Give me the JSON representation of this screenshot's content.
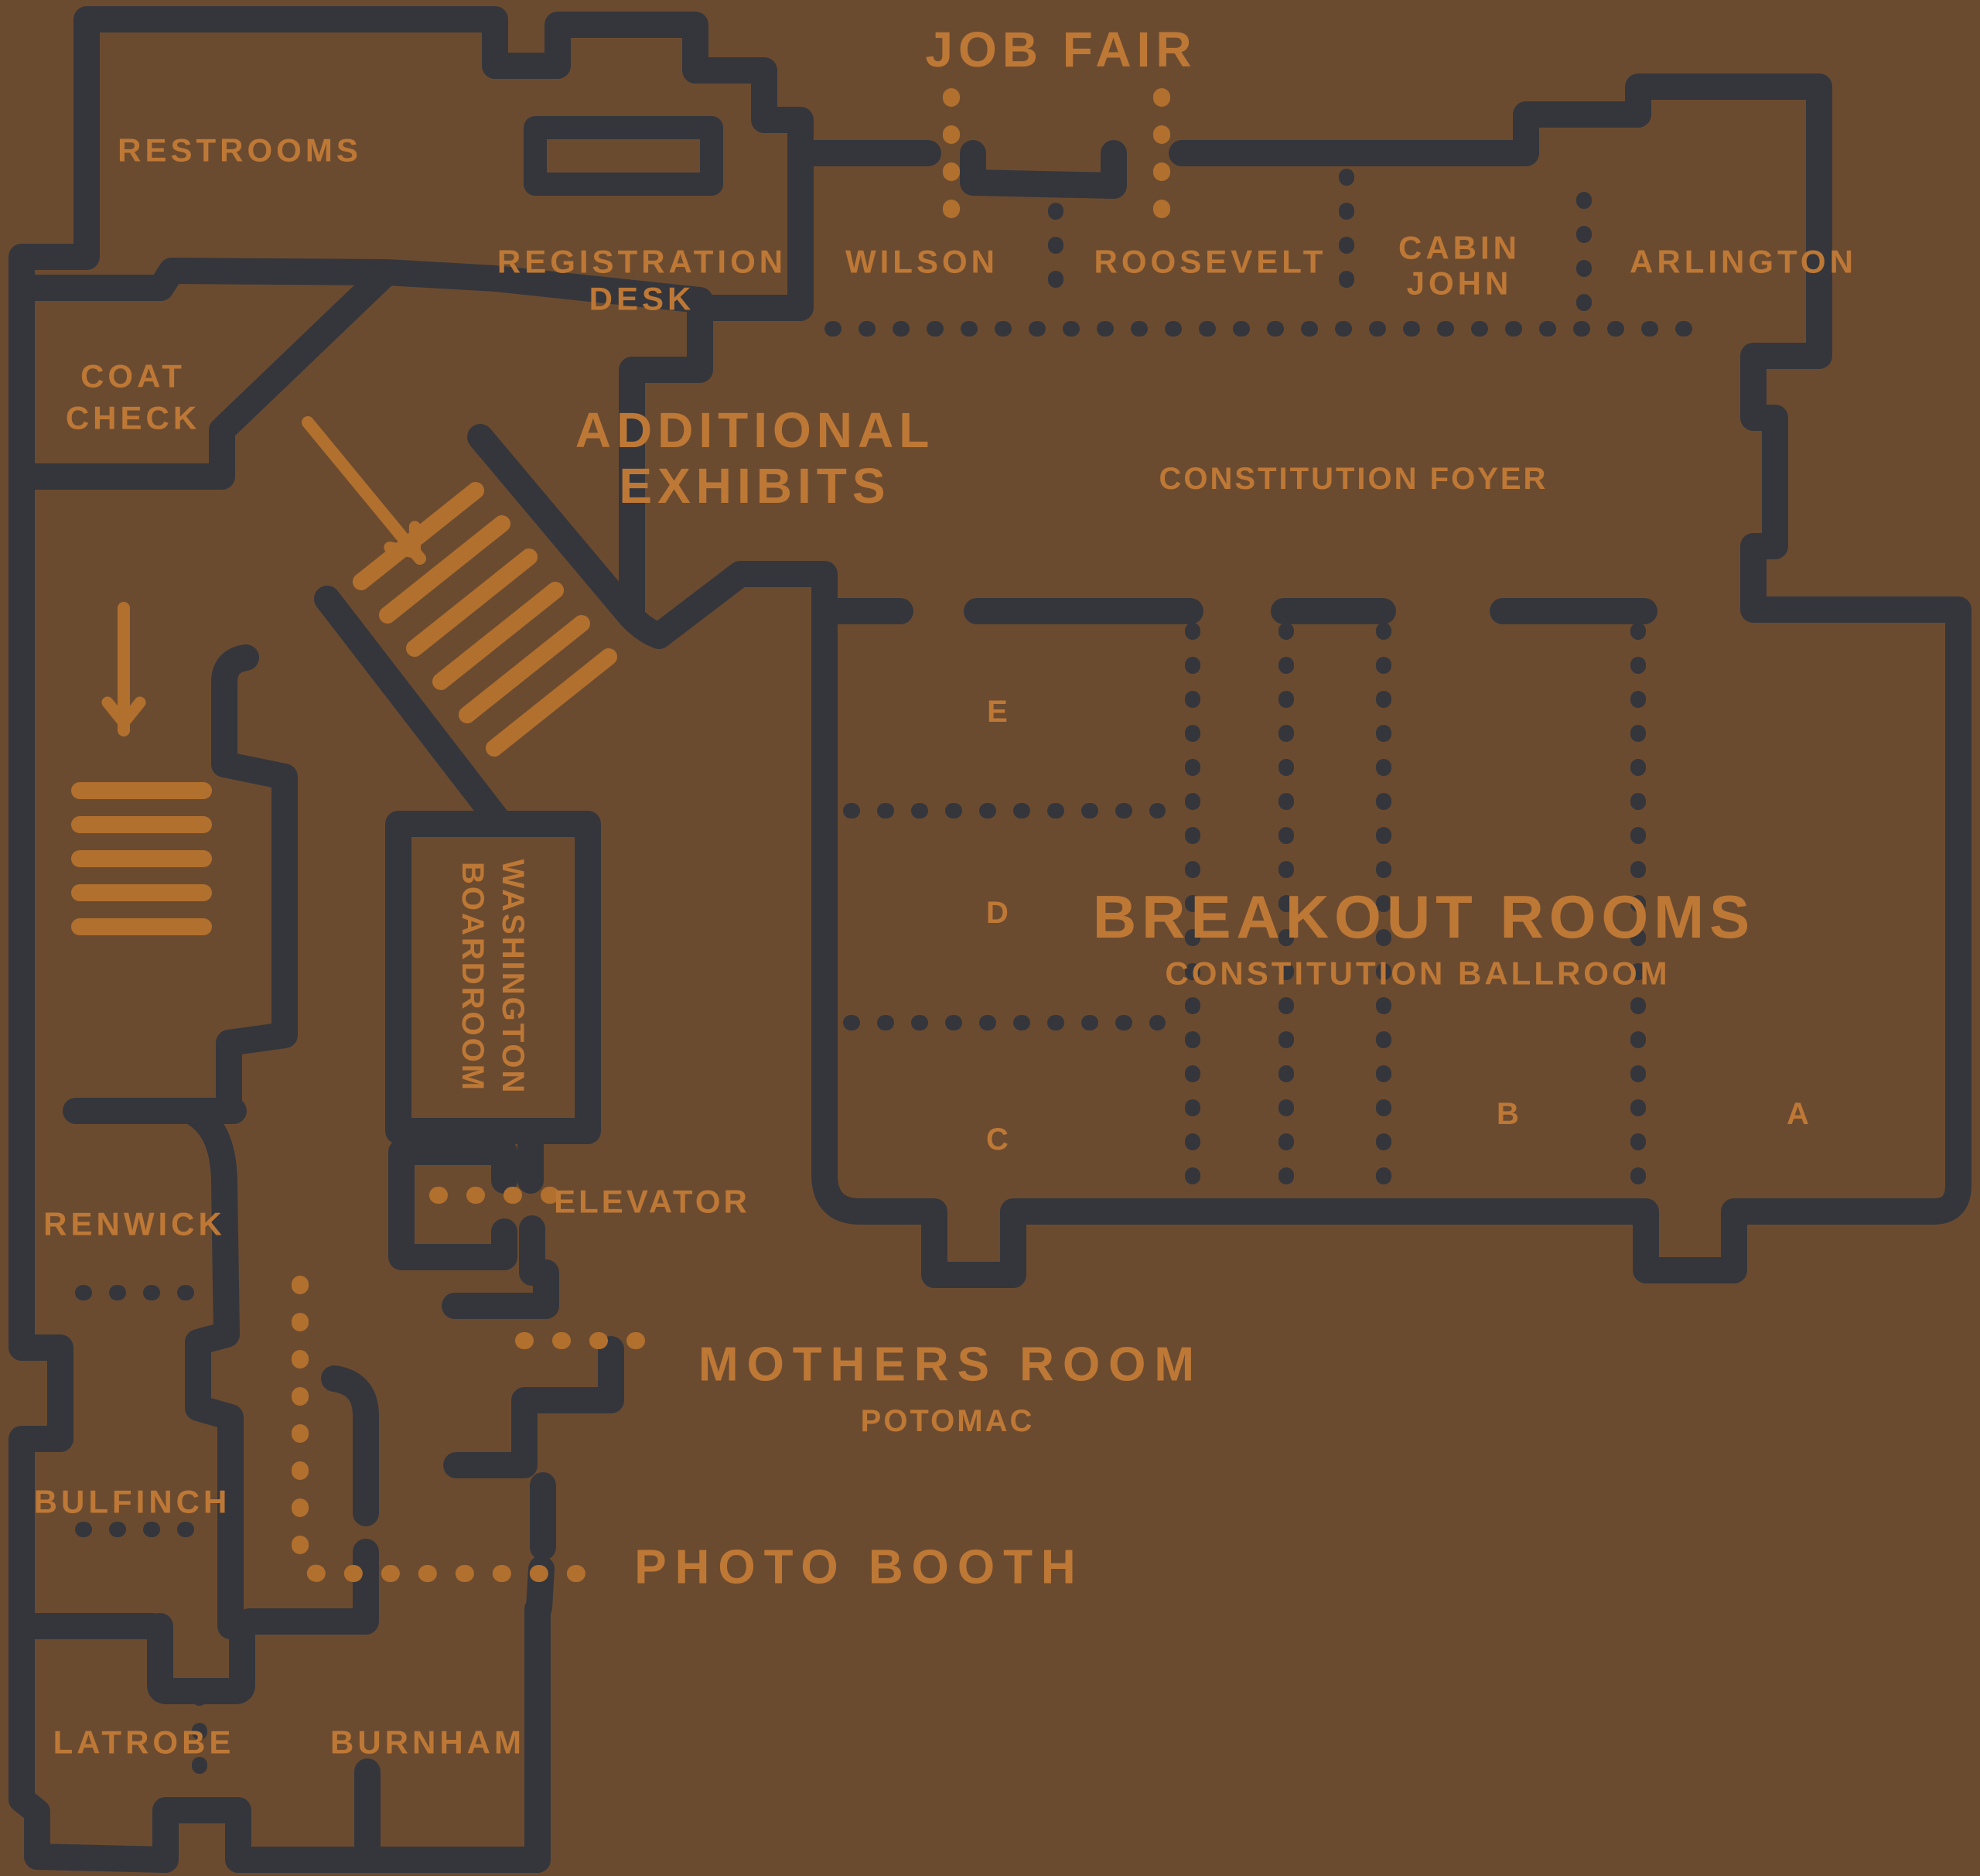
{
  "title": "Conference venue floor plan",
  "colors": {
    "background": "#6B4B30",
    "wall": "#34363C",
    "label_text": "#BE7836",
    "shape_orange": "#B2702E"
  },
  "job_fair": {
    "label": "JOB FAIR"
  },
  "restrooms": {
    "label": "RESTROOMS"
  },
  "registration": {
    "line1": "REGISTRATION",
    "line2": "DESK"
  },
  "coat_check": {
    "line1": "COAT",
    "line2": "CHECK"
  },
  "top_rooms": {
    "wilson": "WILSON",
    "roosevelt": "ROOSEVELT",
    "cabin_john_line1": "CABIN",
    "cabin_john_line2": "JOHN",
    "arlington": "ARLINGTON"
  },
  "additional_exhibits": {
    "line1": "ADDITIONAL",
    "line2": "EXHIBITS"
  },
  "foyer": {
    "label": "CONSTITUTION FOYER"
  },
  "breakout": {
    "title": "BREAKOUT ROOMS",
    "subtitle": "CONSTITUTION BALLROOM",
    "sections": [
      "E",
      "D",
      "C",
      "B",
      "A"
    ]
  },
  "washington_boardroom": {
    "line1": "WASHINGTON",
    "line2": "BOARDROOM"
  },
  "elevator": {
    "label": "ELEVATOR"
  },
  "left_rooms": {
    "renwick": "RENWICK",
    "bulfinch": "BULFINCH",
    "latrobe": "LATROBE",
    "burnham": "BURNHAM"
  },
  "mothers_room": {
    "title": "MOTHERS ROOM",
    "subtitle": "POTOMAC"
  },
  "photo_booth": {
    "label": "PHOTO BOOTH"
  },
  "decorations": {
    "escalator_icon": "diagonal striped escalator/stairs to additional exhibits",
    "stairs_icon": "striped staircase at lower left",
    "arrow_exhibits_icon": "orange arrow pointing down-right into exhibits stairs",
    "arrow_stairs_icon": "orange arrow pointing down into staircase",
    "dotted_dark": "movable partition / air-wall divider",
    "dotted_orange": "wayfinding path"
  }
}
